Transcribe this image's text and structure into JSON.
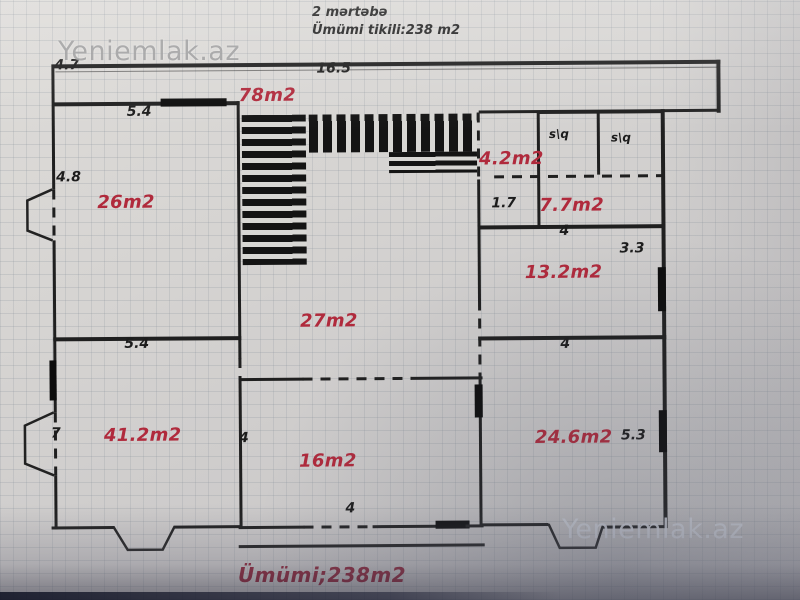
{
  "header": {
    "floor": "2 mərtəbə",
    "total_built": "Ümümi tikili:238 m2"
  },
  "footer": {
    "total": "Ümümi;238m2"
  },
  "watermarks": {
    "top_left": "Yeniemlak.az",
    "bottom_right": "Yeniemlak.az"
  },
  "rooms": [
    {
      "label": "78m2"
    },
    {
      "label": "26m2"
    },
    {
      "label": "4.2m2"
    },
    {
      "label": "7.7m2"
    },
    {
      "label": "13.2m2"
    },
    {
      "label": "27m2"
    },
    {
      "label": "41.2m2"
    },
    {
      "label": "16m2"
    },
    {
      "label": "24.6m2"
    }
  ],
  "dims": [
    {
      "text": "4.7"
    },
    {
      "text": "16.5"
    },
    {
      "text": "5.4"
    },
    {
      "text": "4.8"
    },
    {
      "text": "s\\q"
    },
    {
      "text": "s\\q"
    },
    {
      "text": "1.7"
    },
    {
      "text": "4"
    },
    {
      "text": "3.3"
    },
    {
      "text": "5.4"
    },
    {
      "text": "4"
    },
    {
      "text": "7"
    },
    {
      "text": "4"
    },
    {
      "text": "5.3"
    },
    {
      "text": "4"
    }
  ],
  "colors": {
    "room_label": "#b02a3c",
    "dimension_text": "#1c1c1c",
    "footer_text": "#8e2136",
    "wall": "#1f1f1f",
    "paper": "#d4d2d0"
  }
}
